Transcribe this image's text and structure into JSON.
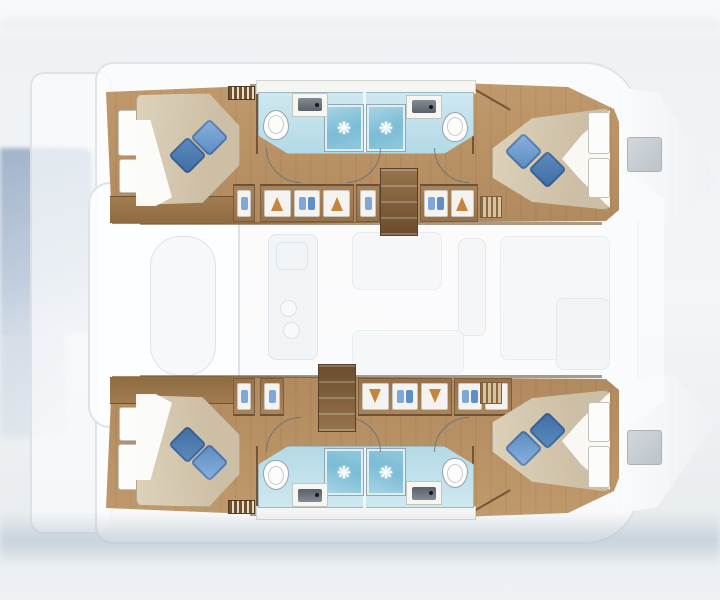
{
  "meta": {
    "view": "catamaran interior deck plan, top-down",
    "orientation": "bow-right",
    "detailed_zones": "two hulls rendered in full color; central saloon, cockpit and bows shown ghosted"
  },
  "icons": {
    "showerhead": "❋"
  },
  "colors": {
    "wood": "#b08a5e",
    "stairs": "#6b4c2c",
    "bath": "#b2dae6",
    "shower": "#7cbcd6",
    "duvet": "#cdbfa5",
    "pillow-dark": "#3f6da3",
    "pillow-light": "#5a8ac0",
    "hanger": "#c4853e",
    "shirt": "#7fa8d8",
    "water": "#94a9c4",
    "hatch": "#bcc3c9"
  },
  "floorplan": {
    "hulls": [
      {
        "id": "upper-hull",
        "rooms": [
          "aft double cabin with two blue pillows",
          "aft bathroom: sink, toilet, shower",
          "forward bathroom: sink, toilet, shower",
          "corridor with wardrobes and vent",
          "companionway stairs",
          "forward double cabin with two blue pillows"
        ]
      },
      {
        "id": "lower-hull",
        "rooms": [
          "aft double cabin with two blue pillows",
          "aft bathroom: sink, toilet, shower",
          "forward bathroom: sink, toilet, shower",
          "corridor with wardrobes and vent",
          "companionway stairs",
          "forward double cabin with two blue pillows"
        ]
      }
    ],
    "ghosted": [
      "saloon and galley blobs",
      "stern platform and helm",
      "bow hatches",
      "foredeck",
      "water reflection at port side"
    ]
  }
}
